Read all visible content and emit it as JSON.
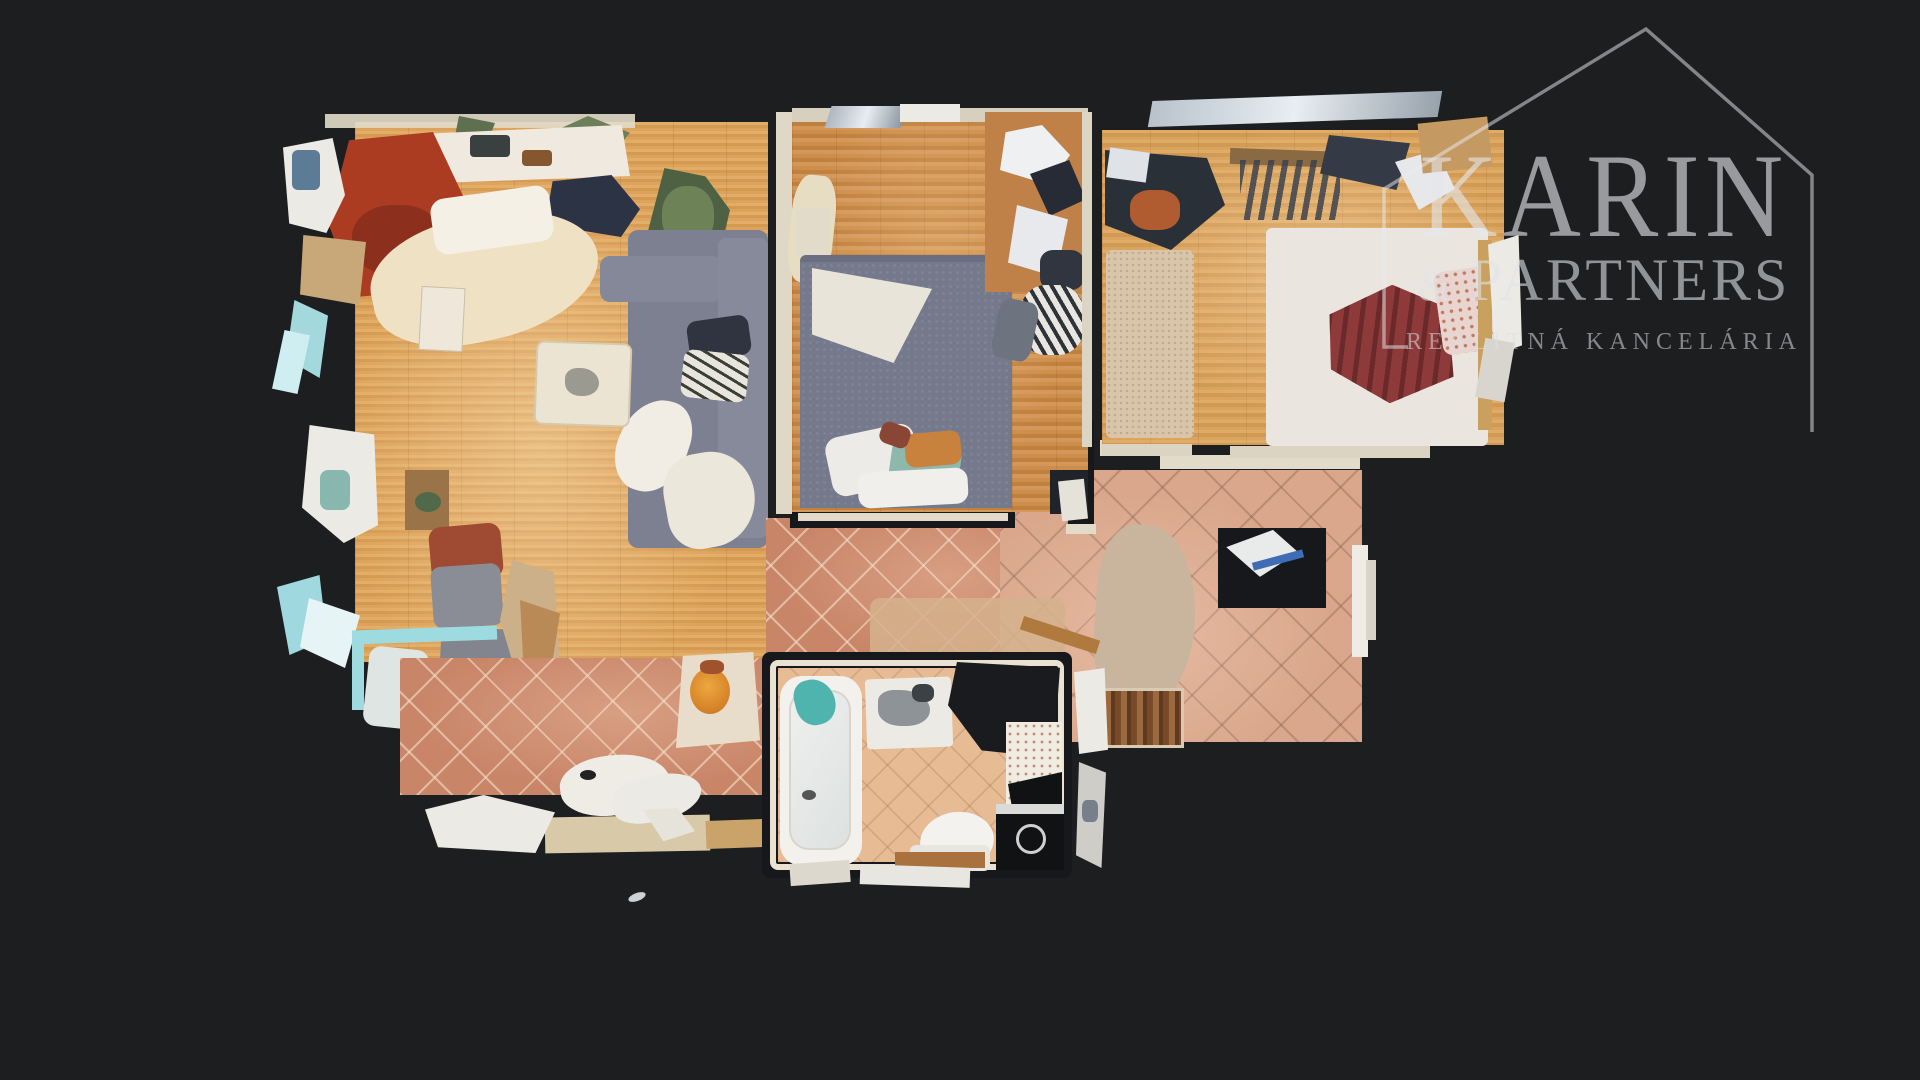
{
  "scene": {
    "description": "3D dollhouse top-down scan of an apartment (real-estate virtual tour view)",
    "background": "#1d1e20"
  },
  "watermark": {
    "brand": "KARIN",
    "ampersand": "&",
    "partners": "PARTNERS",
    "tagline": "REALITNÁ KANCELÁRIA",
    "color": "#e4e6eb"
  },
  "palette": {
    "wood_living": "#d9a258",
    "wood_bedroom_middle": "#c8894b",
    "wood_bedroom_right": "#d9a763",
    "tile_hallway": "#c98568",
    "tile_kitchen": "#daa78c",
    "tile_bathroom": "#e7bc95",
    "wall_top": "#e3dbc9",
    "wall_gap": "#17181c",
    "sofa_gray": "#7c8090",
    "bed_blue": "#75798c",
    "bed_white": "#eae6df",
    "blanket_red": "#8e3a3a",
    "accent_cyan_glass": "#9edbe1"
  }
}
